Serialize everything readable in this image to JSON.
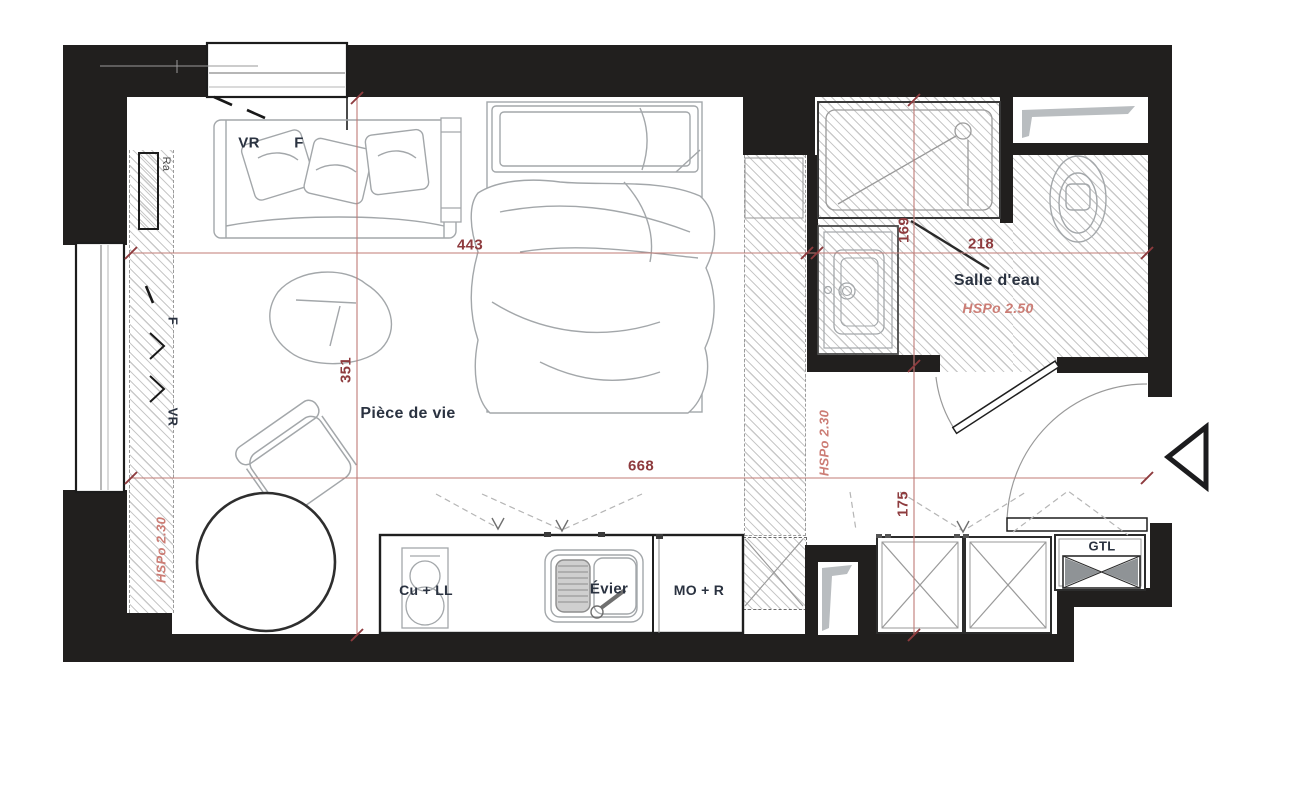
{
  "plan": {
    "rooms": {
      "living_room": "Pièce de vie",
      "bathroom": "Salle d'eau"
    },
    "annotations": {
      "vr_top": "VR",
      "f_top": "F",
      "ra": "Ra",
      "f_left": "F",
      "vr_left": "VR",
      "hspo_left": "HSPo 2.30",
      "hspo_mid": "HSPo 2.30",
      "hspo_bath": "HSPo 2.50"
    },
    "fixtures": {
      "cooktop_washer": "Cu + LL",
      "sink": "Évier",
      "micro_fridge": "MO + R",
      "gtl": "GTL"
    },
    "dimensions": {
      "living_width": "443",
      "bath_width": "218",
      "total_width": "668",
      "living_depth": "351",
      "bath_depth": "169",
      "entry_depth": "175"
    },
    "colors": {
      "wall": "#211f1e",
      "dimension_text": "#8e3b3e",
      "dimension_line": "#c07b76",
      "ceiling_note": "#cc7d75",
      "label": "#2a3240",
      "furniture": "#a3a7aa"
    }
  }
}
